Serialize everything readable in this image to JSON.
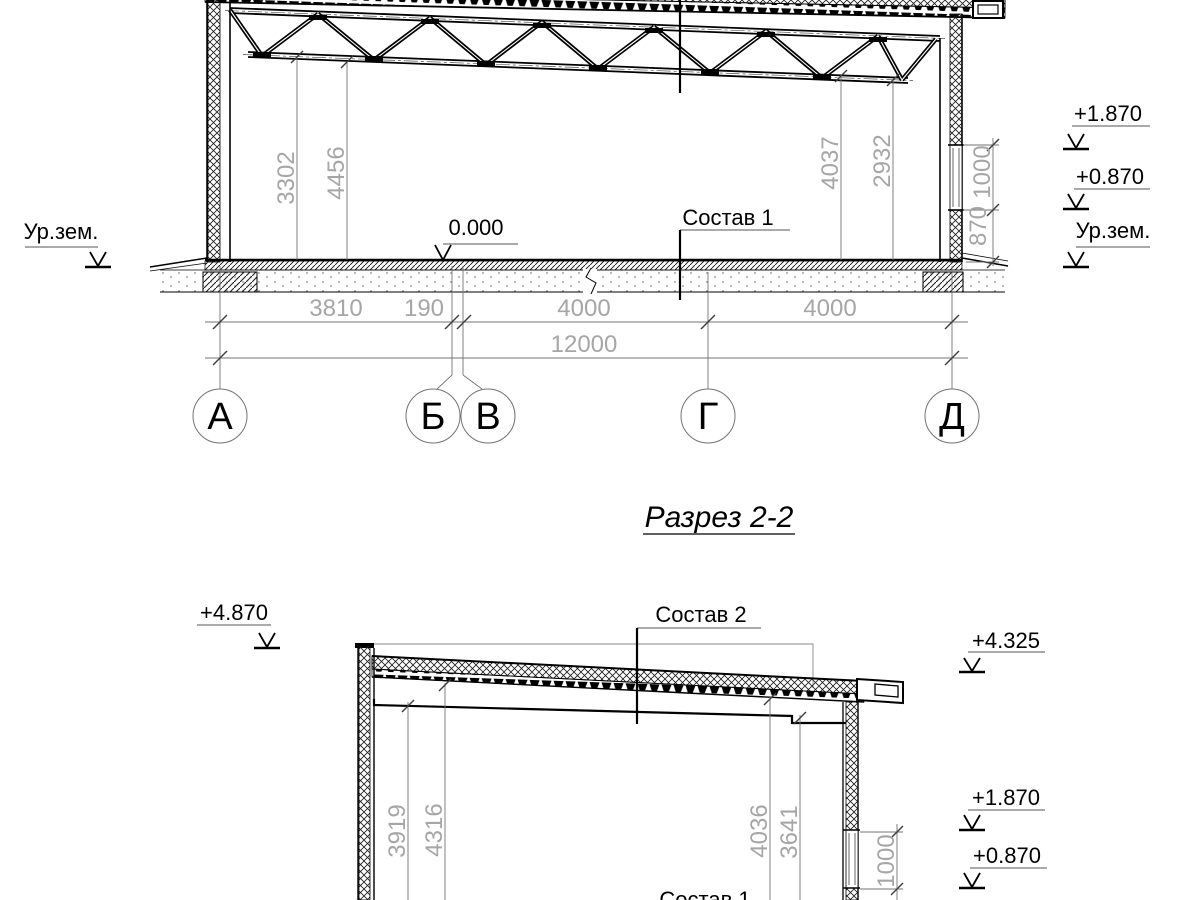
{
  "title": "Разрез 2-2",
  "upper": {
    "elev": {
      "left_ground": "Ур.зем.",
      "r1": "+1.870",
      "r2": "+0.870",
      "r3": "Ур.зем."
    },
    "zero_mark": "0.000",
    "leader_floor": "Состав 1",
    "vdims": {
      "v1": "3302",
      "v2": "4456",
      "v3": "4037",
      "v4": "2932",
      "wall_upper": "1000",
      "wall_lower": "870"
    },
    "hdims": {
      "d1": "3810",
      "d2": "190",
      "d3": "4000",
      "d4": "4000",
      "total": "12000"
    },
    "axes": [
      "А",
      "Б",
      "В",
      "Г",
      "Д"
    ]
  },
  "lower": {
    "elev": {
      "l_top": "+4.870",
      "r_top": "+4.325",
      "r_mid": "+1.870",
      "r_low": "+0.870"
    },
    "leader_roof": "Состав 2",
    "leader_floor": "Состав 1",
    "vdims": {
      "v1": "3919",
      "v2": "4316",
      "v3": "4036",
      "v4": "3641",
      "window": "1000"
    }
  }
}
